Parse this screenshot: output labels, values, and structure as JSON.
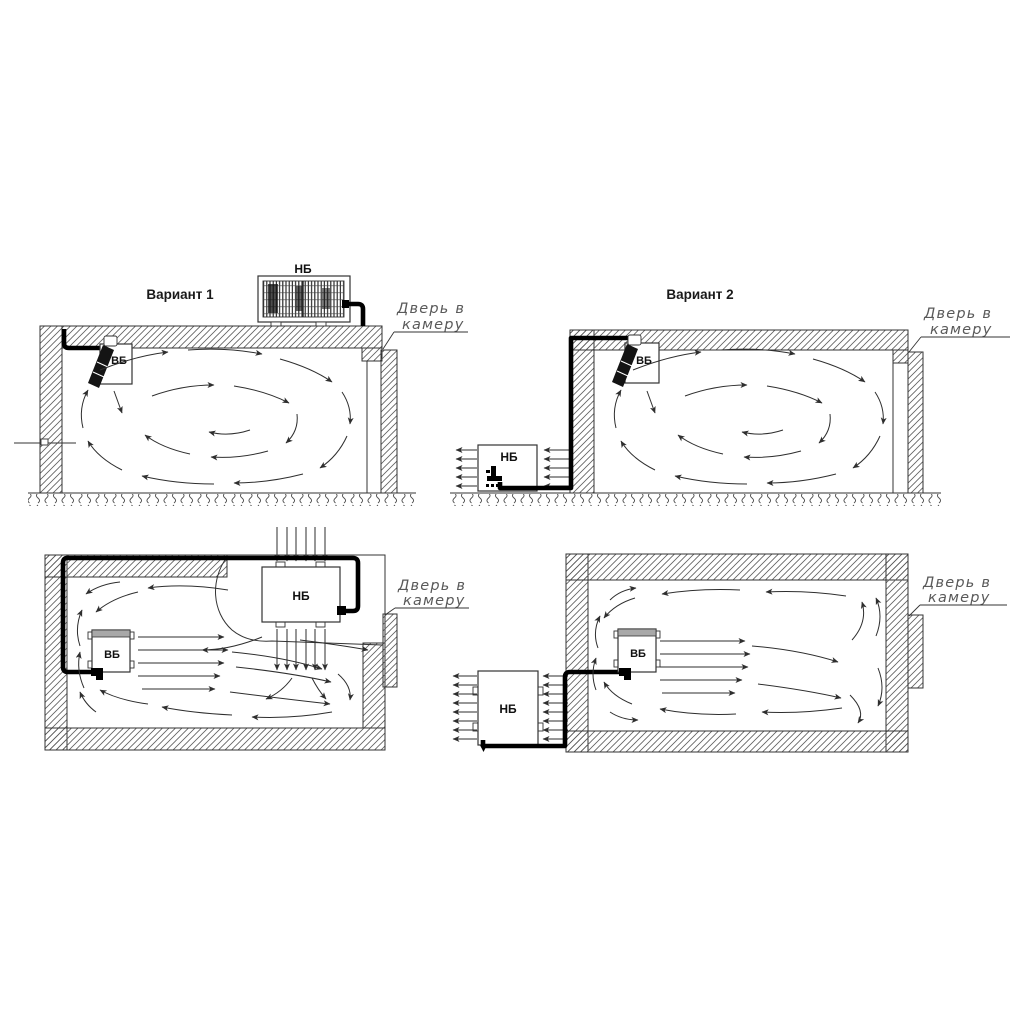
{
  "figure": {
    "variant1_title": "Вариант 1",
    "variant2_title": "Вариант 2",
    "unit_labels": {
      "outdoor": "НБ",
      "indoor": "ВБ"
    },
    "door_annotation": {
      "line1": "Дверь в",
      "line2": "камеру"
    },
    "colors": {
      "ink": "#333333",
      "pipe": "#000000",
      "airflow": "#2e2e2e",
      "annotation": "#5a5a5a",
      "unit_label": "#111111"
    }
  }
}
